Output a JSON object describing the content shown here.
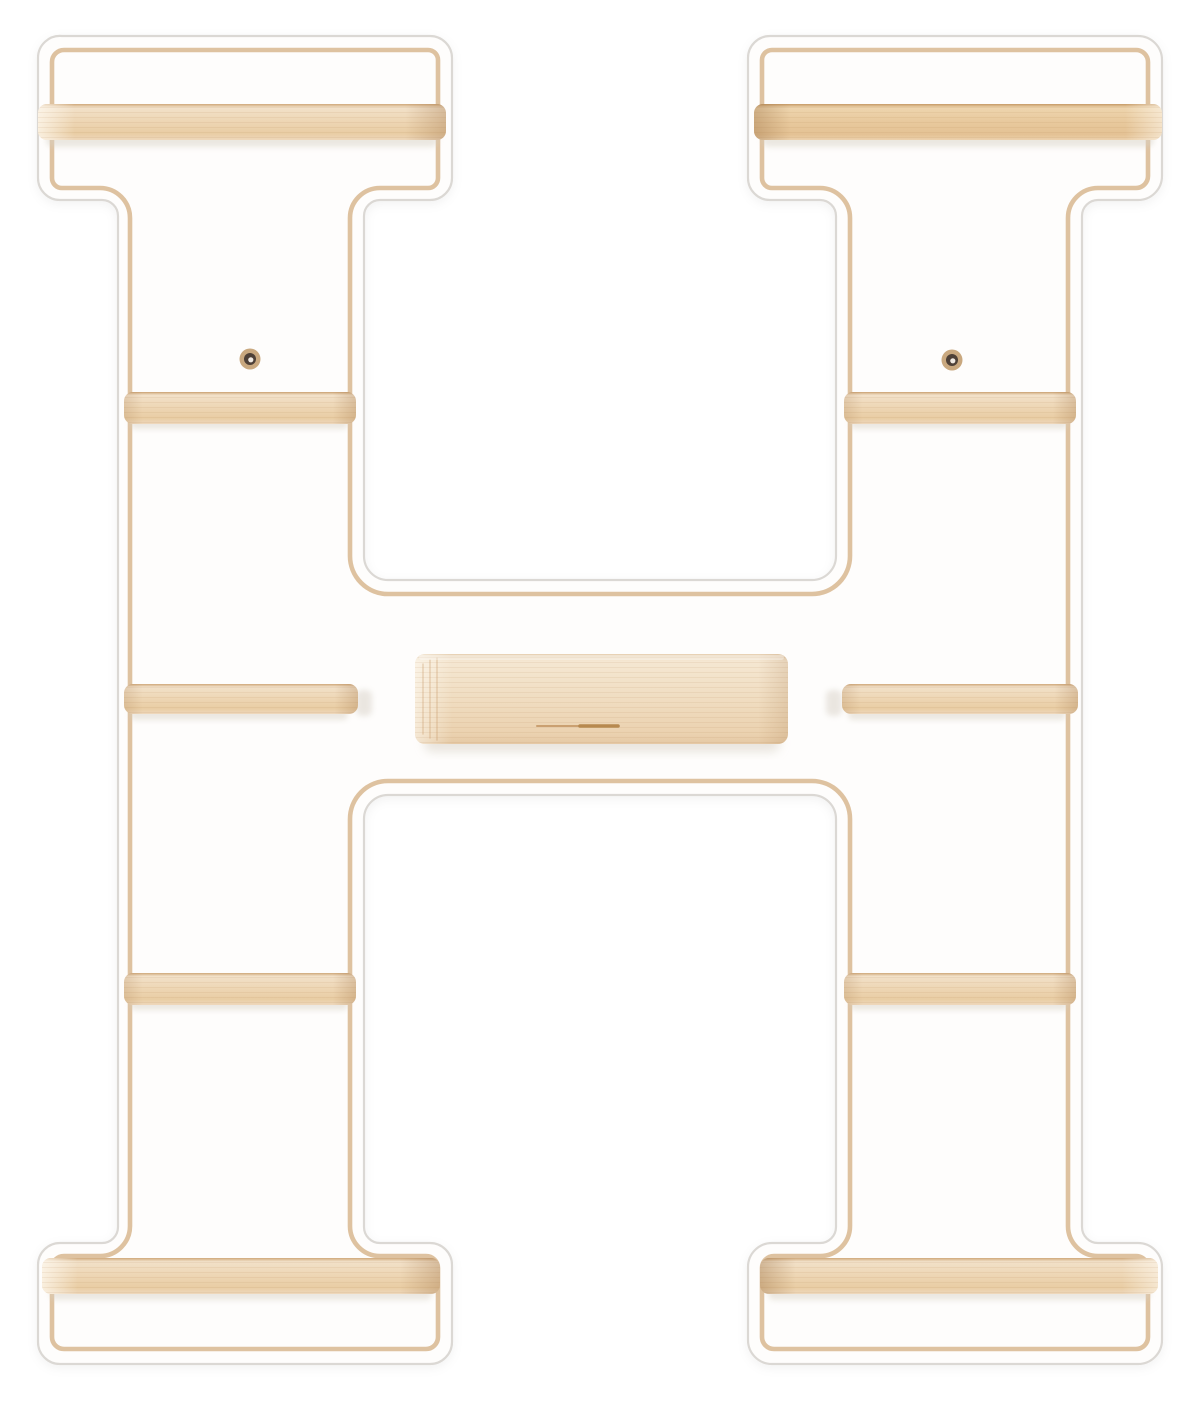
{
  "photo": {
    "subject": "Wall shelf shaped like the capital letter H: white panel with inset plywood outline and natural beech wood shelf bars",
    "background": "#ffffff"
  },
  "panel": {
    "face": "#fefdfc",
    "edge_line": "#dbd8d4",
    "wood_outline": "#dcbf9b"
  },
  "shelf_bars": {
    "count": 10,
    "grad": {
      "rim": "#cfa87a",
      "light": "#f2e1c9",
      "mid": "#eed7b6",
      "deep": "#e9cda4",
      "base": "#eed8bc"
    },
    "warm": {
      "rim": "#c69a66",
      "light": "#eed5ae",
      "mid": "#e8c99d",
      "deep": "#e4c294",
      "base": "#ecd2ae"
    }
  },
  "center_block": {
    "grad": {
      "rim": "#e7d1b3",
      "light": "#f5e7d2",
      "mid": "#f0ddc1",
      "deep": "#ebd2b0",
      "base": "#e5c9a5"
    },
    "slot_left": "#caa071",
    "slot_right": "#b7894f",
    "grain_line": "#c89a6b"
  },
  "screws": {
    "count": 2,
    "ring": "#c9a87f",
    "hole": "#4e4037",
    "glint": "#efe9e2"
  },
  "shadow": {
    "soft": "#d8d1c5",
    "end": "#cdc5b8"
  }
}
